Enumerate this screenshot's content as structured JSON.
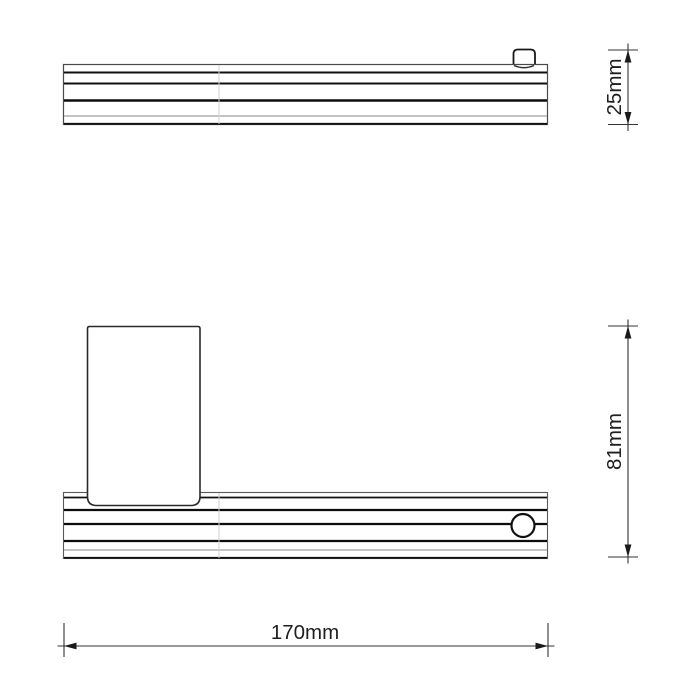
{
  "drawing": {
    "background": "#ffffff",
    "line_color": "#1a1a1a",
    "dimensions": {
      "depth": {
        "label": "25mm",
        "value": 25,
        "unit": "mm"
      },
      "height": {
        "label": "81mm",
        "value": 81,
        "unit": "mm"
      },
      "width": {
        "label": "170mm",
        "value": 170,
        "unit": "mm"
      }
    }
  }
}
